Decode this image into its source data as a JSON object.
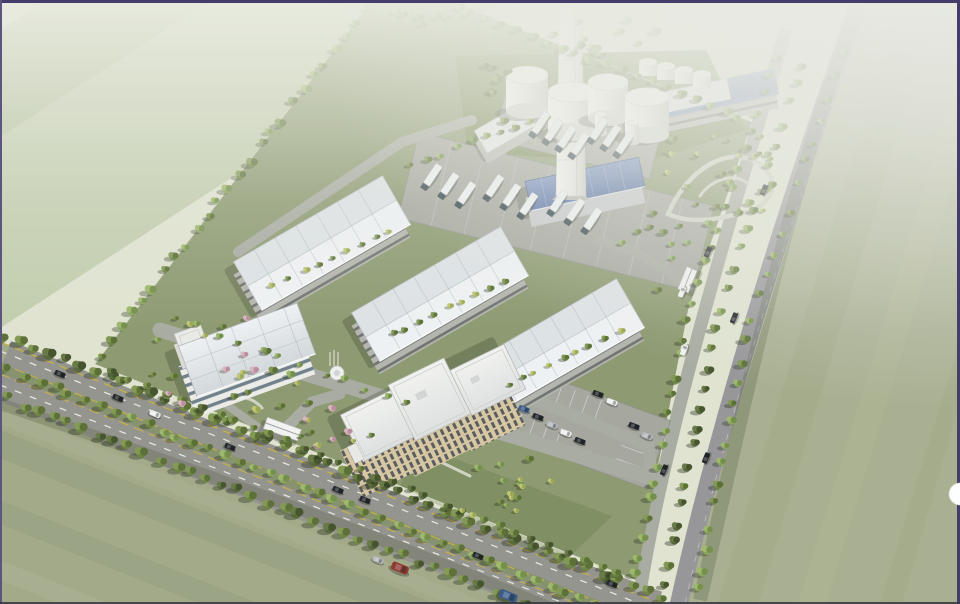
{
  "scene_type": "aerial architectural rendering of an industrial park campus",
  "palette": {
    "border": "#443c69",
    "borderSide": "#5b5680",
    "borderBottom": "#35363e",
    "fieldBase": "#dfe3d0",
    "f1": "#e9ecdc",
    "f2": "#dde3cf",
    "f3": "#d0d8c0",
    "f4": "#c2cdae",
    "f5": "#b4c19d",
    "swBase": "#a2aa8a",
    "sw1": "#aeb495",
    "sw2": "#949d7d",
    "seBase": "#a9b092",
    "se1": "#9fa785",
    "se2": "#b0b795",
    "asphalt": "#95958f",
    "eroad": "#97979a",
    "iroad": "#a9aca2",
    "median": "#87936f",
    "campus": "#8d9a72",
    "yard": "#7a8a57",
    "lot": "#a6a8a0",
    "whWall": "#b4b5ae",
    "beige": "#d7c7a2",
    "win": "#3c4450",
    "officeWhite": "#ebece8",
    "glass": "#5d707c",
    "blueRoof": "#7089ba",
    "lane": "#e9e9e2",
    "laneY": "#c3b04a",
    "fence": "#d7dacd",
    "carD": "#24282c",
    "carW": "#eef0ef",
    "carS": "#b6bbbf",
    "carB": "#3c5c88",
    "carR": "#8e3c33",
    "truckBody": "#eef1f2",
    "truckCab": "#33454c"
  },
  "inventory": {
    "warehouses": 3,
    "large_storage_tanks": 4,
    "rooftop_tanks": 4,
    "silos": 2,
    "chimneys": 1,
    "boiler_house": 1,
    "admin_building_floors": 5,
    "lab_building_floors": 2,
    "gatehouses": 2,
    "trucks": 18,
    "cars": 27,
    "fountain": 1
  },
  "scene": {
    "tree_lines": [
      [
        0,
        334,
        668,
        600,
        46,
        "12",
        0.9,
        1.35,
        5
      ],
      [
        0,
        366,
        620,
        614,
        40,
        "23",
        0.8,
        1.15,
        4
      ],
      [
        0,
        396,
        548,
        614,
        36,
        "12",
        0.9,
        1.3,
        5
      ],
      [
        95,
        362,
        372,
        2,
        26,
        "23",
        0.75,
        1.15,
        5
      ],
      [
        104,
        370,
        628,
        576,
        30,
        "12",
        0.65,
        1.0,
        4
      ],
      [
        450,
        4,
        748,
        120,
        20,
        "23",
        0.7,
        1.05,
        4
      ],
      [
        634,
        584,
        688,
        312,
        15,
        "23",
        0.75,
        1.05,
        4
      ],
      [
        688,
        312,
        782,
        46,
        14,
        "23",
        0.65,
        0.95,
        4
      ],
      [
        664,
        592,
        718,
        320,
        14,
        "12",
        0.75,
        1.05,
        4
      ],
      [
        718,
        320,
        806,
        54,
        13,
        "23",
        0.65,
        0.95,
        4
      ],
      [
        696,
        600,
        748,
        332,
        13,
        "23",
        0.75,
        1.05,
        4
      ],
      [
        748,
        332,
        848,
        42,
        13,
        "23",
        0.6,
        0.9,
        4
      ],
      [
        268,
        288,
        398,
        228,
        9,
        "24",
        0.5,
        0.75,
        3
      ],
      [
        384,
        338,
        512,
        278,
        9,
        "24",
        0.5,
        0.75,
        3
      ],
      [
        500,
        390,
        626,
        328,
        9,
        "24",
        0.5,
        0.75,
        3
      ],
      [
        404,
        168,
        556,
        112,
        10,
        "23",
        0.55,
        0.85,
        4
      ],
      [
        168,
        316,
        420,
        408,
        12,
        "23",
        0.5,
        0.8,
        5
      ]
    ],
    "tree_clusters": [
      [
        222,
        372,
        78,
        58,
        22,
        "2345",
        0.5,
        0.9
      ],
      [
        332,
        424,
        46,
        34,
        12,
        "245",
        0.5,
        0.8
      ],
      [
        470,
        482,
        82,
        40,
        16,
        "234",
        0.5,
        0.85
      ],
      [
        722,
        172,
        72,
        56,
        26,
        "234",
        0.5,
        0.9
      ],
      [
        655,
        252,
        36,
        42,
        10,
        "23",
        0.55,
        0.85
      ],
      [
        492,
        95,
        32,
        30,
        8,
        "12",
        0.6,
        0.95
      ],
      [
        610,
        38,
        62,
        24,
        12,
        "23",
        0.6,
        1.0
      ],
      [
        430,
        20,
        40,
        16,
        8,
        "23",
        0.6,
        0.95
      ]
    ],
    "cars": [
      [
        60,
        374,
        22,
        "d",
        1
      ],
      [
        118,
        398,
        22,
        "d",
        1
      ],
      [
        155,
        414,
        22,
        "w",
        1
      ],
      [
        230,
        447,
        22,
        "d",
        1
      ],
      [
        338,
        490,
        22,
        "d",
        1
      ],
      [
        365,
        500,
        22,
        "d",
        1
      ],
      [
        378,
        560,
        22,
        "s",
        1
      ],
      [
        400,
        568,
        22,
        "r",
        1.6
      ],
      [
        478,
        556,
        22,
        "d",
        1
      ],
      [
        508,
        596,
        22,
        "b",
        1.7
      ],
      [
        612,
        584,
        22,
        "d",
        1
      ],
      [
        706,
        458,
        -68,
        "d",
        1
      ],
      [
        734,
        318,
        -68,
        "d",
        1
      ],
      [
        764,
        190,
        -68,
        "d",
        1
      ],
      [
        664,
        470,
        -68,
        "d",
        1
      ],
      [
        684,
        350,
        -68,
        "w",
        1
      ],
      [
        708,
        252,
        -68,
        "d",
        1
      ],
      [
        524,
        409,
        20,
        "b",
        1
      ],
      [
        538,
        417,
        20,
        "d",
        1
      ],
      [
        552,
        425,
        20,
        "s",
        1
      ],
      [
        566,
        433,
        20,
        "w",
        1
      ],
      [
        580,
        441,
        20,
        "d",
        1
      ],
      [
        598,
        394,
        20,
        "d",
        1
      ],
      [
        612,
        402,
        20,
        "w",
        1
      ],
      [
        634,
        426,
        20,
        "d",
        1
      ],
      [
        647,
        436,
        20,
        "s",
        1
      ],
      [
        682,
        292,
        -68,
        "w",
        1
      ]
    ],
    "trucks": [
      [
        540,
        124,
        -56
      ],
      [
        553,
        131,
        -56
      ],
      [
        566,
        138,
        -56
      ],
      [
        579,
        145,
        -56
      ],
      [
        598,
        130,
        -56
      ],
      [
        611,
        137,
        -56
      ],
      [
        624,
        144,
        -56
      ],
      [
        432,
        176,
        -56
      ],
      [
        449,
        185,
        -56
      ],
      [
        466,
        194,
        -56
      ],
      [
        494,
        187,
        -56
      ],
      [
        511,
        196,
        -56
      ],
      [
        528,
        205,
        -56
      ],
      [
        558,
        202,
        -56
      ],
      [
        575,
        211,
        -56
      ],
      [
        592,
        220,
        -56
      ]
    ]
  },
  "ui": {
    "edge_button": {
      "shape": "half-circle",
      "color": "#ffffff"
    }
  }
}
